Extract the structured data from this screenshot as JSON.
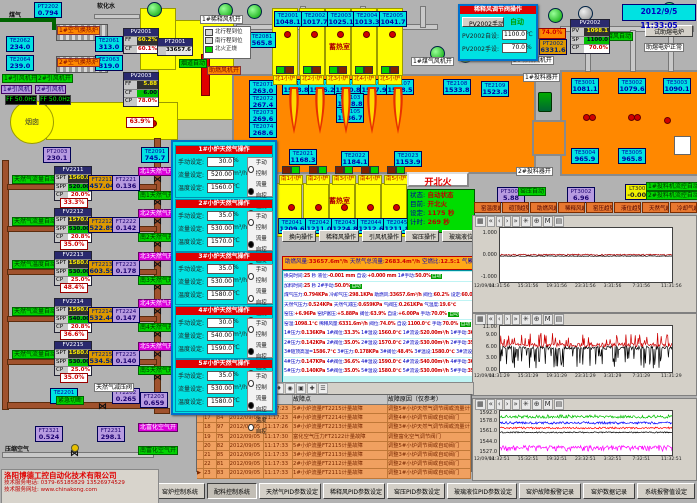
{
  "app": {
    "datetime": "2012/9/5 11:33:05"
  },
  "company": {
    "name": "洛阳博德工控自动化技术有限公司",
    "phone": "技术服务电话: 0379-65185829  13526974529",
    "web": "技术服务网址: www.chinakong.com"
  },
  "boxes": [
    {
      "tag": "PT2202",
      "val": "0.794",
      "t": "c"
    },
    {
      "tag": "TE2062",
      "val": "234.0",
      "t": "c"
    },
    {
      "tag": "TE2064",
      "val": "239.0",
      "t": "c"
    },
    {
      "tag": "TE2061",
      "val": "313.0",
      "t": "c"
    },
    {
      "tag": "TE2063",
      "val": "319.0",
      "t": "c"
    },
    {
      "tag": "TE2091",
      "val": "745.7",
      "t": "c"
    },
    {
      "tag": "PT2003",
      "val": "230.1",
      "t": "p"
    },
    {
      "tag": "TE2081",
      "val": "565.8",
      "t": "c"
    },
    {
      "tag": "TE2001",
      "val": "1048.1",
      "t": "c"
    },
    {
      "tag": "TE2002",
      "val": "1017.7",
      "t": "c"
    },
    {
      "tag": "TE2003",
      "val": "1025.1",
      "t": "c"
    },
    {
      "tag": "TE2004",
      "val": "1013.3",
      "t": "c"
    },
    {
      "tag": "TE2005",
      "val": "1041.7",
      "t": "c"
    },
    {
      "tag": "TE2071",
      "val": "263.0",
      "t": "c"
    },
    {
      "tag": "TE2072",
      "val": "267.4",
      "t": "c"
    },
    {
      "tag": "TE2073",
      "val": "269.6",
      "t": "c"
    },
    {
      "tag": "TE2074",
      "val": "268.6",
      "t": "c"
    },
    {
      "tag": "TE2101",
      "val": "1558.8",
      "t": "c"
    },
    {
      "tag": "TE2102",
      "val": "1566.2",
      "t": "c"
    },
    {
      "tag": "TE2104",
      "val": "1570.8",
      "t": "c"
    },
    {
      "tag": "TE2106",
      "val": "1567.9",
      "t": "c"
    },
    {
      "tag": "TE2107",
      "val": "1538.5",
      "t": "c"
    },
    {
      "tag": "TE2108",
      "val": "1533.8",
      "t": "c"
    },
    {
      "tag": "TE2109",
      "val": "1523.8",
      "t": "c"
    },
    {
      "tag": "TE2103",
      "val": "1578.8",
      "t": "c"
    },
    {
      "tag": "TE2105",
      "val": "1586.7",
      "t": "c"
    },
    {
      "tag": "TE2021",
      "val": "1168.3",
      "t": "c"
    },
    {
      "tag": "TE2022",
      "val": "1184.1",
      "t": "c"
    },
    {
      "tag": "TE2023",
      "val": "1153.9",
      "t": "c"
    },
    {
      "tag": "TE2041",
      "val": "1209.6",
      "t": "c"
    },
    {
      "tag": "TE2042",
      "val": "1211.0",
      "t": "c"
    },
    {
      "tag": "TE2043",
      "val": "1224.8",
      "t": "c"
    },
    {
      "tag": "TE2044",
      "val": "1212.6",
      "t": "c"
    },
    {
      "tag": "TE2045",
      "val": "1211.8",
      "t": "c"
    },
    {
      "tag": "TE3001",
      "val": "1081.1",
      "t": "c"
    },
    {
      "tag": "TE3002",
      "val": "1079.6",
      "t": "c"
    },
    {
      "tag": "TE3003",
      "val": "1090.1",
      "t": "c"
    },
    {
      "tag": "TE3004",
      "val": "965.9",
      "t": "c"
    },
    {
      "tag": "TE3005",
      "val": "965.8",
      "t": "c"
    },
    {
      "tag": "PT3001",
      "val": "5.88",
      "t": "p"
    },
    {
      "tag": "PT3002",
      "val": "6.96",
      "t": "p"
    },
    {
      "tag": "LT3001",
      "val": "-0.001",
      "t": "y"
    },
    {
      "tag": "TE2201",
      "val": "19.6",
      "t": "c"
    },
    {
      "tag": "FT2202",
      "val": "0.265",
      "t": "p"
    },
    {
      "tag": "FT2203",
      "val": "0.659",
      "t": "p"
    },
    {
      "tag": "FT2321",
      "val": "0.524",
      "t": "p"
    },
    {
      "tag": "FT2231",
      "val": "298.1",
      "t": "p"
    },
    {
      "tag": "PT2002",
      "val": "6331.6",
      "t": "o"
    }
  ],
  "labels": [
    "煤气",
    "软化水",
    "1#空气换热炉",
    "2#空气换热炉",
    "1#引风机开",
    "2#引风机开",
    "1#引风机",
    "2#引风机",
    "1#稀释风机开",
    "烟道自动",
    "助燃风机开",
    "1#煤气风机开",
    "2#稀释风机开",
    "1#投料器开",
    "2#投料器开",
    "稀释风自动",
    "窑压自动",
    "1#投料机流控自动",
    "2#投料机流控自动",
    "紧急切断",
    "天然气减压阀",
    "压缩空气",
    "北富化空气开",
    "南富化空气开",
    "烟囱"
  ],
  "vfd": [
    "FF 50.0Hz",
    "FF 50.0Hz"
  ],
  "legend": {
    "rows": [
      {
        "color": "#d8d8d8",
        "text": "北行程到位"
      },
      {
        "color": "#d8d8d8",
        "text": "南行程到位"
      },
      {
        "color": "#00d800",
        "text": "北火正烧"
      }
    ]
  },
  "pv_boxes": [
    {
      "name": "PV2001",
      "rows": [
        {
          "k": "FF",
          "v": "60.2%",
          "s": "s-dy"
        },
        {
          "k": "CF",
          "v": "60.1%",
          "s": "s-wr"
        }
      ]
    },
    {
      "name": "PV2003",
      "rows": [
        {
          "k": "FF",
          "v": "5.88",
          "s": "s-dy"
        },
        {
          "k": "CF",
          "v": "6.00",
          "s": "s-gr"
        },
        {
          "k": "CP",
          "v": "78.0%",
          "s": "s-wr"
        }
      ]
    },
    {
      "name": "PT2001",
      "rows": [
        {
          "k": "",
          "v": "33657.6",
          "s": "s-pl"
        }
      ]
    },
    {
      "name": "PV2002",
      "rows": [
        {
          "k": "PV",
          "v": "1098.1",
          "s": "s-dy"
        },
        {
          "k": "SP",
          "v": "1100.0",
          "s": "s-gr"
        },
        {
          "k": "CP",
          "v": "70.0%",
          "s": "s-wr"
        }
      ]
    }
  ],
  "aux_popup": {
    "title": "稀释风调节阀操作",
    "btn": "PV2002手动",
    "mode": "自动",
    "rows": [
      {
        "label": "PV2002自设:",
        "value": "1100.0",
        "unit": "℃"
      },
      {
        "label": "PV2002手设:",
        "value": "70.0",
        "unit": "%"
      }
    ]
  },
  "boost": {
    "btn": "试助熔电炉",
    "status": "助熔电炉正常"
  },
  "valve_pct": {
    "flue": "63.9%",
    "aux": "74.0%"
  },
  "regen": {
    "label": "蓄热室",
    "north": [
      "北1小炉",
      "北2小炉",
      "北3小炉",
      "北4小炉",
      "北5小炉"
    ],
    "south": [
      "南1小炉",
      "南2小炉",
      "南3小炉",
      "南4小炉",
      "南5小炉"
    ]
  },
  "controllers": [
    {
      "name": "FV2211",
      "spt": "1560.0",
      "spp": "520.00",
      "cp": "20.0%",
      "auto": "天然气流量自动",
      "flow_tag": "FT2211",
      "flow": "457.04",
      "press_tag": "FT2221",
      "press": "0.136",
      "valve": "33.3%",
      "north": "北1天然气开",
      "south": "南1天然气开"
    },
    {
      "name": "FV2212",
      "spt": "1570.0",
      "spp": "530.00",
      "cp": "20.8%",
      "auto": "天然气流量自动",
      "flow_tag": "FT2212",
      "flow": "522.89",
      "press_tag": "FT2222",
      "press": "0.142",
      "valve": "35.0%",
      "north": "北2天然气开",
      "south": "南2天然气开"
    },
    {
      "name": "FV2213",
      "spt": "1580.0",
      "spp": "530.00",
      "cp": "25.0%",
      "auto": "天然气温度自动",
      "flow_tag": "FT2213",
      "flow": "603.59",
      "press_tag": "FT2223",
      "press": "0.178",
      "valve": "48.4%",
      "north": "北3天然气开",
      "south": "南3天然气开"
    },
    {
      "name": "FV2214",
      "spt": "1590.0",
      "spp": "540.00",
      "cp": "20.8%",
      "auto": "天然气流量自动",
      "flow_tag": "FT2214",
      "flow": "532.44",
      "press_tag": "FT2224",
      "press": "0.147",
      "valve": "36.6%",
      "north": "北4天然气开",
      "south": "南4天然气开"
    },
    {
      "name": "FV2215",
      "spt": "1580.0",
      "spp": "530.00",
      "cp": "25.0%",
      "auto": "天然气流量自动",
      "flow_tag": "FT2215",
      "flow": "534.58",
      "press_tag": "FT2225",
      "press": "0.140",
      "valve": "35.0%",
      "north": "北5天然气开",
      "south": "南5天然气开"
    }
  ],
  "popup": {
    "field_labels": [
      "手动设定:",
      "流量设定:",
      "温度设定:"
    ],
    "units": [
      "%",
      "m³/h",
      "℃"
    ],
    "modes": [
      "手动控制",
      "流量自控",
      "温度自控"
    ],
    "sections": [
      {
        "title": "1#小炉天然气操作",
        "manual": "30.0",
        "flow": "520.00",
        "temp": "1560.0",
        "mode": 1
      },
      {
        "title": "2#小炉天然气操作",
        "manual": "35.0",
        "flow": "530.00",
        "temp": "1570.0",
        "mode": 1
      },
      {
        "title": "3#小炉天然气操作",
        "manual": "35.0",
        "flow": "530.00",
        "temp": "1580.0",
        "mode": 2
      },
      {
        "title": "4#小炉天然气操作",
        "manual": "30.0",
        "flow": "540.00",
        "temp": "1590.0",
        "mode": 1
      },
      {
        "title": "5#小炉天然气操作",
        "manual": "35.0",
        "flow": "530.00",
        "temp": "1580.0",
        "mode": 1
      }
    ]
  },
  "fire": {
    "button": "开北火",
    "rows": [
      {
        "k": "状态:",
        "v": "自动状态"
      },
      {
        "k": "目前:",
        "v": "开北火"
      },
      {
        "k": "设定:",
        "v": "1175 秒"
      },
      {
        "k": "计时:",
        "v": "269 秒"
      }
    ]
  },
  "op_buttons": [
    "换向操作",
    "稀释风操作",
    "引风机操作",
    "窑压操作",
    "玻璃液位操作",
    "天然气操作"
  ],
  "summary": [
    [
      "助燃风量:",
      "33657.6m³/h "
    ],
    [
      "天然气总流量:",
      "2683.4m³/h "
    ],
    [
      "空燃比:",
      "12.5:1 "
    ],
    [
      "气累积量:",
      "134857.7m³"
    ]
  ],
  "params": [
    [
      [
        "换向时间:",
        "l"
      ],
      [
        "25 ",
        "v"
      ],
      [
        "秒  ",
        "l"
      ],
      [
        "液位:",
        "l"
      ],
      [
        "-0.001 mm  ",
        "v"
      ],
      [
        "自设:",
        "l"
      ],
      [
        "+0.000 mm  ",
        "v"
      ],
      [
        "1#手动:",
        "l"
      ],
      [
        "50.0%",
        "v"
      ],
      [
        "自动",
        "a"
      ]
    ],
    [
      [
        "加料时间:",
        "l"
      ],
      [
        "25 ",
        "v"
      ],
      [
        "秒  ",
        "l"
      ],
      [
        "2#手动:",
        "l"
      ],
      [
        "50.0%",
        "v"
      ],
      [
        "自动",
        "a"
      ]
    ],
    [
      [
        "煤气压力:",
        "l"
      ],
      [
        "0.794KPa ",
        "v"
      ],
      [
        "冷却气压:",
        "l"
      ],
      [
        "298.1KPa ",
        "v"
      ],
      [
        "助燃风:",
        "l"
      ],
      [
        "33657.6m³/h ",
        "v"
      ],
      [
        "阀位:",
        "l"
      ],
      [
        "60.2% ",
        "v"
      ],
      [
        "设定:",
        "l"
      ],
      [
        "60.0%",
        "v"
      ]
    ],
    [
      [
        "天然气压力:",
        "l"
      ],
      [
        "0.524KPa ",
        "v"
      ],
      [
        "天然气减压:",
        "l"
      ],
      [
        "0.659KPa ",
        "v"
      ],
      [
        "气阀压:",
        "l"
      ],
      [
        "0.261KPa ",
        "v"
      ],
      [
        "气温度:",
        "l"
      ],
      [
        "19.6℃",
        "v"
      ]
    ],
    [
      [
        "窑压:",
        "l"
      ],
      [
        "+6.96Pa ",
        "v"
      ],
      [
        "窑炉富压:",
        "l"
      ],
      [
        "+5.88Pa ",
        "v"
      ],
      [
        "阀位:",
        "l"
      ],
      [
        "63.9% ",
        "v"
      ],
      [
        "自设:",
        "l"
      ],
      [
        "+6.00Pa ",
        "v"
      ],
      [
        "手动:",
        "l"
      ],
      [
        "70.0% ",
        "v"
      ],
      [
        "自动",
        "a"
      ]
    ],
    [
      [
        "窑温:",
        "l"
      ],
      [
        "1098.1℃ ",
        "v"
      ],
      [
        "稀释风量:",
        "l"
      ],
      [
        "6331.6m³/h ",
        "v"
      ],
      [
        "阀位:",
        "l"
      ],
      [
        "74.0% ",
        "v"
      ],
      [
        "自设:",
        "l"
      ],
      [
        "1100.0℃ ",
        "v"
      ],
      [
        "手动:",
        "l"
      ],
      [
        "70.0% ",
        "v"
      ],
      [
        "自动",
        "a"
      ]
    ],
    [
      [
        "1#压力:",
        "l"
      ],
      [
        "0.136KPa ",
        "v"
      ],
      [
        "1#阀位:",
        "l"
      ],
      [
        "33.3% ",
        "v"
      ],
      [
        "1#温设:",
        "l"
      ],
      [
        "1560.0℃ ",
        "v"
      ],
      [
        "1#流设:",
        "l"
      ],
      [
        "520.00m³/h ",
        "v"
      ],
      [
        "1#手动:",
        "l"
      ],
      [
        "30.0% ",
        "v"
      ],
      [
        "流控",
        "f"
      ]
    ],
    [
      [
        "2#压力:",
        "l"
      ],
      [
        "0.142KPa ",
        "v"
      ],
      [
        "2#阀位:",
        "l"
      ],
      [
        "35.0% ",
        "v"
      ],
      [
        "2#温设:",
        "l"
      ],
      [
        "1570.0℃ ",
        "v"
      ],
      [
        "2#流设:",
        "l"
      ],
      [
        "530.00m³/h ",
        "v"
      ],
      [
        "2#手动:",
        "l"
      ],
      [
        "35.0% ",
        "v"
      ],
      [
        "流控",
        "f"
      ]
    ],
    [
      [
        "3#碹顶高温=",
        "l"
      ],
      [
        "1586.7℃ ",
        "v"
      ],
      [
        "3#压力:",
        "l"
      ],
      [
        "0.178KPa ",
        "v"
      ],
      [
        "3#阀位:",
        "l"
      ],
      [
        "48.4% ",
        "v"
      ],
      [
        "3#温设:",
        "l"
      ],
      [
        "1580.0℃ ",
        "v"
      ],
      [
        "3#流设:",
        "l"
      ],
      [
        "530.00m³/h ",
        "v"
      ],
      [
        "3#手动:",
        "l"
      ],
      [
        "35.0% ",
        "v"
      ],
      [
        "温控",
        "t"
      ]
    ],
    [
      [
        "4#压力:",
        "l"
      ],
      [
        "0.147KPa ",
        "v"
      ],
      [
        "4#阀位:",
        "l"
      ],
      [
        "36.6% ",
        "v"
      ],
      [
        "4#温设:",
        "l"
      ],
      [
        "1590.0℃ ",
        "v"
      ],
      [
        "4#流设:",
        "l"
      ],
      [
        "540.00m³/h ",
        "v"
      ],
      [
        "4#手动:",
        "l"
      ],
      [
        "30.0% ",
        "v"
      ],
      [
        "流控",
        "f"
      ]
    ],
    [
      [
        "5#压力:",
        "l"
      ],
      [
        "0.140KPa ",
        "v"
      ],
      [
        "5#阀位:",
        "l"
      ],
      [
        "35.0% ",
        "v"
      ],
      [
        "5#温设:",
        "l"
      ],
      [
        "1580.0℃ ",
        "v"
      ],
      [
        "5#流设:",
        "l"
      ],
      [
        "530.00m³/h ",
        "v"
      ],
      [
        "5#手动:",
        "l"
      ],
      [
        "35.0% ",
        "v"
      ],
      [
        "流控",
        "f"
      ]
    ]
  ],
  "trend_buttons": [
    "窑温度趋势",
    "碹顶趋势",
    "助燃风趋势",
    "稀释风趋势",
    "窑压趋势",
    "液位趋势",
    "天然气趋势",
    "冷却气趋势"
  ],
  "chart_data": [
    {
      "type": "line",
      "title": "窑压趋势",
      "ylim": [
        -1.2,
        1.3
      ],
      "ytick_vals": [
        1.0,
        0.0,
        -1.0
      ],
      "ytick_labels": [
        "1.000",
        "0.000",
        "-1.000"
      ],
      "date": "12/09/04",
      "xticks": [
        "11:31:56",
        "15:31:56",
        "19:31:56",
        "23:31:56",
        "3:31:56",
        "7:31:56",
        "11:31:56"
      ],
      "series": [
        {
          "name": "窑压",
          "color": "#b00000",
          "base": 0.06,
          "amp": 0.03,
          "spike": 0,
          "spikeProb": 0
        },
        {
          "name": "设定",
          "color": "#000000",
          "base": 0.0,
          "amp": 0.015,
          "spike": 0,
          "spikeProb": 0
        }
      ]
    },
    {
      "type": "line",
      "title": "窑炉压力趋势",
      "ylim": [
        -0.3,
        11.6
      ],
      "ytick_vals": [
        11,
        9,
        6,
        3,
        0
      ],
      "ytick_labels": [
        "11.00",
        "9.00",
        "6.00",
        "3.00",
        "0.00"
      ],
      "date": "12/09/04",
      "xticks": [
        "11:31:29",
        "15:31:29",
        "19:31:29",
        "23:31:29",
        "3:31:29",
        "7:31:29",
        "11:31:29"
      ],
      "series": [
        {
          "name": "压力1",
          "color": "#000000",
          "base": 6.0,
          "amp": 0.5,
          "spike": -4.5,
          "spikeProb": 0.25
        },
        {
          "name": "压力2",
          "color": "#cc0000",
          "base": 6.7,
          "amp": 0.55,
          "spike": 2.6,
          "spikeProb": 0.2
        }
      ]
    },
    {
      "type": "line",
      "title": "窑温趋势",
      "ylim": [
        1523,
        1597
      ],
      "ytick_vals": [
        1592,
        1578,
        1561,
        1544,
        1527
      ],
      "ytick_labels": [
        "1592.0",
        "1578.0",
        "1561.0",
        "1544.0",
        "1527.0"
      ],
      "date": "12/09/04",
      "xticks": [
        "11:32:51",
        "15:32:51",
        "19:32:51",
        "23:32:51",
        "3:32:51",
        "7:32:51",
        "11:32:51"
      ],
      "series": [
        {
          "name": "5#温度",
          "color": "#ff00ff",
          "base": 1536.5,
          "amp": 2.5,
          "spike": -6,
          "spikeProb": 0.25
        },
        {
          "name": "4#温度",
          "color": "#000000",
          "base": 1561.0,
          "amp": 1.0,
          "spike": 0,
          "spikeProb": 0
        },
        {
          "name": "3#温度",
          "color": "#ff0000",
          "base": 1568.5,
          "amp": 1.5,
          "spike": 0,
          "spikeProb": 0
        },
        {
          "name": "2#温度",
          "color": "#0000ff",
          "base": 1577.0,
          "amp": 2.0,
          "spike": 0,
          "spikeProb": 0
        },
        {
          "name": "1#温度",
          "color": "#00c000",
          "base": 1587.0,
          "amp": 2.0,
          "spike": 3,
          "spikeProb": 0.2
        }
      ]
    }
  ],
  "alarm": {
    "headers": [
      "故障点",
      "故障原因（仅参考）"
    ],
    "rows": [
      [
        "",
        "16",
        "98",
        "2012/09/05",
        "11:17:23",
        "5#小炉流量FT2215计量故障",
        "调整5#小炉天然气调节阀或流量计"
      ],
      [
        "",
        "17",
        "84",
        "2012/09/05",
        "11:17:23",
        "4#小炉流量FT2214计量故障",
        "调整4#小炉调节阀或自动阀门"
      ],
      [
        "",
        "18",
        "97",
        "2012/09/05",
        "11:17:26",
        "3#小炉流量FT2213计量故障",
        "调整3#小炉天然气调节阀或流量计"
      ],
      [
        "",
        "19",
        "75",
        "2012/09/05",
        "11:17:30",
        "富化空气压力FT2122计量故障",
        "调整富化空气调节阀门"
      ],
      [
        "",
        "20",
        "82",
        "2012/09/05",
        "11:17:33",
        "5#小炉流量FT2115计量故障",
        "调整5#小炉调节阀或自动阀门"
      ],
      [
        "",
        "21",
        "85",
        "2012/09/05",
        "11:17:33",
        "3#小炉流量FT2113计量故障",
        "调整3#小炉调节阀或自动阀门"
      ],
      [
        "",
        "22",
        "81",
        "2012/09/05",
        "11:17:33",
        "2#小炉流量FT2112计量故障",
        "调整2#小炉调节阀或自动阀门"
      ],
      [
        "▶",
        "23",
        "83",
        "2012/09/05",
        "11:17:33",
        "1#小炉流量FT2111计量故障",
        "调整1#小炉调节阀或自动阀门"
      ]
    ]
  },
  "bottom_buttons": [
    "窑炉控制系统",
    "配料控制系统",
    "天然气PID参数设定",
    "稀释风PID参数设定",
    "窑压PID参数设定",
    "玻璃液位PID参数设定",
    "窑炉故障报警记录",
    "窑炉数据记录",
    "系统报警值设定"
  ]
}
